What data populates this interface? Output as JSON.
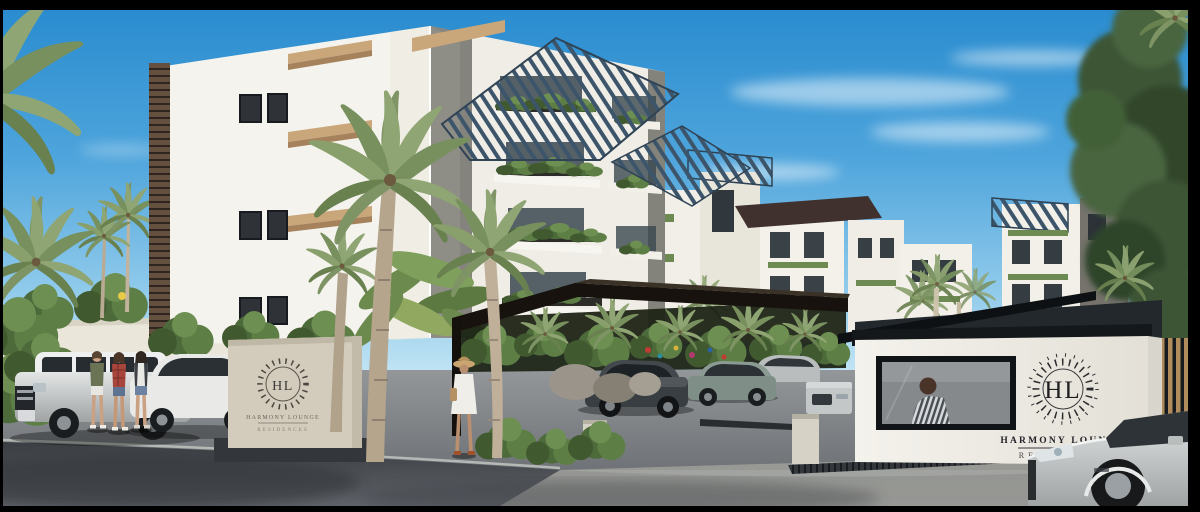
{
  "scene": {
    "kind": "3d-architectural-rendering",
    "subject": "Gated tropical apartment complex entrance with palm trees, carport canopy, gatehouse, parked cars and pedestrians",
    "letterbox": "black frame bars on all four edges"
  },
  "signs": {
    "entrance_wall": {
      "monogram": "HL",
      "line1": "HARMONY LOUNGE",
      "line2": "RESIDENCES"
    },
    "gatehouse": {
      "monogram": "HL",
      "line1": "HARMONY LOUNGE",
      "line2": "RESIDENCES"
    }
  },
  "palette": {
    "sky_top": "#2a8ccf",
    "sky_horizon": "#dff0f8",
    "facade_white": "#f4f2ed",
    "facade_shade": "#e2dfd5",
    "stone_gray": "#8e8d86",
    "slat_brown": "#5d4c3c",
    "wood_tan": "#c9a77b",
    "pergola_slate": "#3c556b",
    "canopy_dark": "#221a12",
    "foliage_green": "#6f8a58",
    "foliage_dark": "#3b5232",
    "road_asphalt": "#44484c",
    "concrete_light": "#9b9c98",
    "sign_stone": "#d3ccbc",
    "charcoal": "#22272b",
    "car_white": "#eceeed",
    "car_dark": "#42484c",
    "car_sage": "#8b9b93",
    "car_silver": "#c9cbca"
  }
}
